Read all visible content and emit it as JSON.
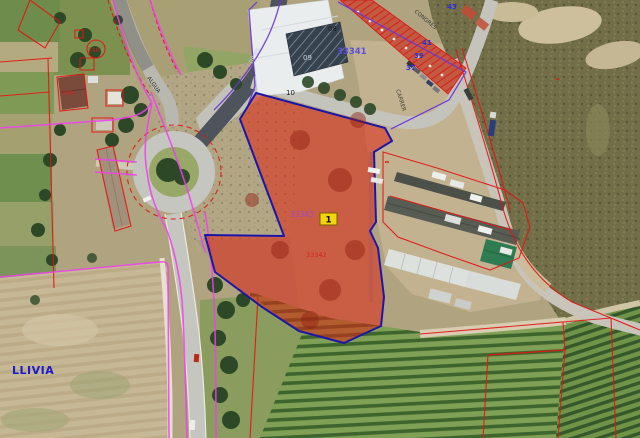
{
  "labels": {
    "town": "LLIVIA",
    "marker": "1",
    "code_33341": "33341",
    "code_33343": "33343",
    "code_33342": "33342",
    "bld_08": "08",
    "bld_09": "09",
    "bld_10": "10",
    "house_43": "43",
    "house_41": "41",
    "house_39": "39",
    "house_37": "37",
    "plot_240": "240",
    "plot_008": "008",
    "street_west": "ALGUA",
    "street_east": "CARRER",
    "street_northeast": "CONGRES",
    "road_code": "DP 4N"
  },
  "colors": {
    "parcel_fill": "#df2413",
    "parcel_border": "#1c16a8",
    "marker_bg": "#f2d50a",
    "cadastral_red": "#e41414",
    "cadastral_magenta": "#f23ef0",
    "cadastral_purple": "#6a35d8",
    "label_blue": "#2830dc",
    "town_blue": "#1a1acc"
  }
}
